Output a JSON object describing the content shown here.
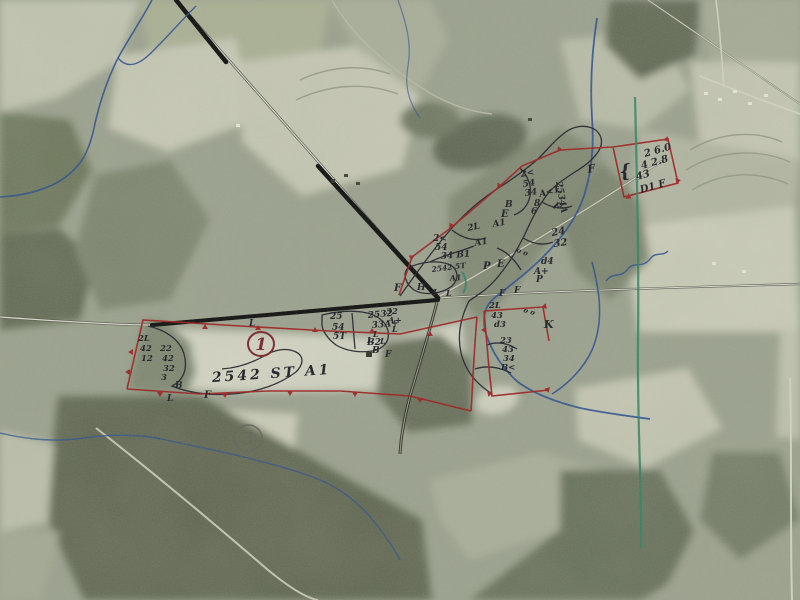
{
  "map": {
    "kind": "annotated-aerial-survey-photo",
    "colors": {
      "ink": "#1a1a22",
      "red": "#9b1d1d",
      "pencil": "#5f6457",
      "stream": "#2c4f8e",
      "green_line": "#2e7f5f"
    },
    "parcel_markers": [
      {
        "number": "1",
        "x": 261,
        "y": 344,
        "r": 13,
        "color": "red"
      },
      {
        "number": "3",
        "x": 248,
        "y": 438,
        "r": 14,
        "color": "pencil"
      }
    ],
    "annotations": [
      {
        "text": "2 6.0",
        "x": 645,
        "y": 157,
        "rot": -16,
        "size": 10
      },
      {
        "text": "4 2.8",
        "x": 642,
        "y": 169,
        "rot": -16,
        "size": 10
      },
      {
        "text": "43",
        "x": 637,
        "y": 180,
        "rot": -16,
        "size": 10
      },
      {
        "text": "D1 F",
        "x": 641,
        "y": 193,
        "rot": -16,
        "size": 10
      },
      {
        "text": "{",
        "x": 620,
        "y": 178,
        "rot": -8,
        "size": 18
      },
      {
        "text": "F",
        "x": 588,
        "y": 173,
        "rot": -10,
        "size": 11
      },
      {
        "text": "2534A",
        "x": 556,
        "y": 182,
        "rot": 80,
        "size": 9
      },
      {
        "text": "F",
        "x": 552,
        "y": 207,
        "rot": 35,
        "size": 10
      },
      {
        "text": "2<",
        "x": 521,
        "y": 177,
        "rot": -10,
        "size": 9
      },
      {
        "text": "54",
        "x": 523,
        "y": 187,
        "rot": -8,
        "size": 9
      },
      {
        "text": "34",
        "x": 525,
        "y": 196,
        "rot": -8,
        "size": 9
      },
      {
        "text": "A<1",
        "x": 540,
        "y": 197,
        "rot": -15,
        "size": 9
      },
      {
        "text": "8",
        "x": 534,
        "y": 206,
        "rot": 0,
        "size": 9
      },
      {
        "text": "6",
        "x": 531,
        "y": 214,
        "rot": 0,
        "size": 9
      },
      {
        "text": "B",
        "x": 505,
        "y": 207,
        "rot": 0,
        "size": 9
      },
      {
        "text": "E",
        "x": 501,
        "y": 217,
        "rot": 0,
        "size": 10
      },
      {
        "text": "A1",
        "x": 493,
        "y": 227,
        "rot": -10,
        "size": 9
      },
      {
        "text": "o o",
        "x": 516,
        "y": 252,
        "rot": 20,
        "size": 7
      },
      {
        "text": "2L",
        "x": 468,
        "y": 231,
        "rot": -12,
        "size": 9
      },
      {
        "text": "A1",
        "x": 475,
        "y": 246,
        "rot": -10,
        "size": 9
      },
      {
        "text": "2<",
        "x": 433,
        "y": 241,
        "rot": 0,
        "size": 9
      },
      {
        "text": "54",
        "x": 435,
        "y": 250,
        "rot": 0,
        "size": 9
      },
      {
        "text": "34 B1",
        "x": 441,
        "y": 259,
        "rot": -5,
        "size": 9
      },
      {
        "text": "24",
        "x": 552,
        "y": 236,
        "rot": -10,
        "size": 10
      },
      {
        "text": "32",
        "x": 554,
        "y": 247,
        "rot": -8,
        "size": 10
      },
      {
        "text": "d4",
        "x": 541,
        "y": 264,
        "rot": 0,
        "size": 9
      },
      {
        "text": "A+",
        "x": 534,
        "y": 274,
        "rot": 0,
        "size": 9
      },
      {
        "text": "P",
        "x": 536,
        "y": 282,
        "rot": 0,
        "size": 9
      },
      {
        "text": "P",
        "x": 483,
        "y": 269,
        "rot": 0,
        "size": 10
      },
      {
        "text": "E",
        "x": 497,
        "y": 267,
        "rot": 0,
        "size": 10
      },
      {
        "text": "F",
        "x": 499,
        "y": 296,
        "rot": 0,
        "size": 9
      },
      {
        "text": "F",
        "x": 514,
        "y": 293,
        "rot": 0,
        "size": 9
      },
      {
        "text": "K",
        "x": 544,
        "y": 328,
        "rot": 0,
        "size": 11
      },
      {
        "text": "2L",
        "x": 489,
        "y": 308,
        "rot": 0,
        "size": 8.5
      },
      {
        "text": "43",
        "x": 491,
        "y": 318,
        "rot": 0,
        "size": 8.5
      },
      {
        "text": "d3",
        "x": 494,
        "y": 327,
        "rot": 0,
        "size": 8.5
      },
      {
        "text": "o o",
        "x": 523,
        "y": 312,
        "rot": 15,
        "size": 7
      },
      {
        "text": "23",
        "x": 500,
        "y": 343,
        "rot": 0,
        "size": 8.5
      },
      {
        "text": "43",
        "x": 502,
        "y": 352,
        "rot": 0,
        "size": 8.5
      },
      {
        "text": "34",
        "x": 503,
        "y": 361,
        "rot": 0,
        "size": 8.5
      },
      {
        "text": "B<",
        "x": 501,
        "y": 370,
        "rot": 0,
        "size": 8.5
      },
      {
        "text": "2542 5T",
        "x": 432,
        "y": 272,
        "rot": -7,
        "size": 7.5
      },
      {
        "text": "A1",
        "x": 450,
        "y": 281,
        "rot": -5,
        "size": 8
      },
      {
        "text": "H",
        "x": 417,
        "y": 290,
        "rot": 0,
        "size": 9
      },
      {
        "text": "L",
        "x": 433,
        "y": 295,
        "rot": 0,
        "size": 8
      },
      {
        "text": "L",
        "x": 446,
        "y": 296,
        "rot": 0,
        "size": 8
      },
      {
        "text": "F",
        "x": 394,
        "y": 291,
        "rot": 0,
        "size": 10
      },
      {
        "text": "32",
        "x": 386,
        "y": 314,
        "rot": 0,
        "size": 8.5
      },
      {
        "text": "A+",
        "x": 388,
        "y": 323,
        "rot": 0,
        "size": 8.5
      },
      {
        "text": "L",
        "x": 392,
        "y": 332,
        "rot": 0,
        "size": 8
      },
      {
        "text": "L",
        "x": 367,
        "y": 343,
        "rot": 0,
        "size": 8
      },
      {
        "text": "L",
        "x": 380,
        "y": 344,
        "rot": 0,
        "size": 8
      },
      {
        "text": "B",
        "x": 372,
        "y": 353,
        "rot": 0,
        "size": 9
      },
      {
        "text": "F",
        "x": 385,
        "y": 357,
        "rot": 0,
        "size": 9
      },
      {
        "text": "L",
        "x": 249,
        "y": 326,
        "rot": 0,
        "size": 9
      },
      {
        "text": "25",
        "x": 330,
        "y": 319,
        "rot": 0,
        "size": 9
      },
      {
        "text": "54",
        "x": 332,
        "y": 330,
        "rot": 0,
        "size": 9
      },
      {
        "text": "5T",
        "x": 333,
        "y": 339,
        "rot": 0,
        "size": 9
      },
      {
        "text": "2532",
        "x": 368,
        "y": 318,
        "rot": -5,
        "size": 9
      },
      {
        "text": "33A+",
        "x": 372,
        "y": 328,
        "rot": -5,
        "size": 9
      },
      {
        "text": "L",
        "x": 373,
        "y": 337,
        "rot": 0,
        "size": 8
      },
      {
        "text": "B2",
        "x": 367,
        "y": 345,
        "rot": 0,
        "size": 9
      },
      {
        "text": "2L",
        "x": 138,
        "y": 341,
        "rot": 0,
        "size": 8.5
      },
      {
        "text": "42",
        "x": 140,
        "y": 351,
        "rot": 0,
        "size": 8.5
      },
      {
        "text": "12",
        "x": 141,
        "y": 361,
        "rot": 0,
        "size": 8.5
      },
      {
        "text": "22",
        "x": 160,
        "y": 351,
        "rot": 0,
        "size": 8.5
      },
      {
        "text": "42",
        "x": 162,
        "y": 361,
        "rot": 0,
        "size": 8.5
      },
      {
        "text": "32",
        "x": 163,
        "y": 371,
        "rot": 0,
        "size": 8.5
      },
      {
        "text": "3",
        "x": 161,
        "y": 380,
        "rot": 0,
        "size": 8.5
      },
      {
        "text": "B",
        "x": 175,
        "y": 388,
        "rot": 0,
        "size": 9
      },
      {
        "text": "L",
        "x": 167,
        "y": 401,
        "rot": 0,
        "size": 9
      },
      {
        "text": "F",
        "x": 204,
        "y": 398,
        "rot": 0,
        "size": 10
      },
      {
        "text": "2542 ST A1",
        "x": 272,
        "y": 378,
        "rot": -4,
        "size": 14,
        "spacing": 3,
        "anchor": "middle"
      }
    ]
  }
}
